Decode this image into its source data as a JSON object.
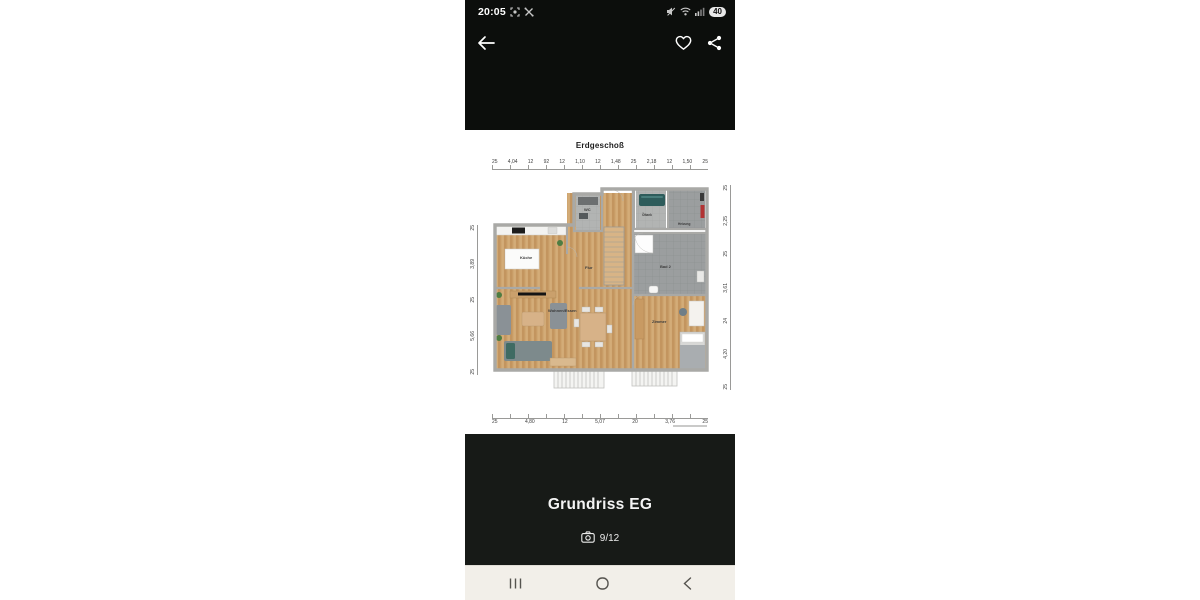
{
  "status_bar": {
    "time": "20:05",
    "left_icons": [
      "screen-record-icon",
      "crossed-tools-icon"
    ],
    "right_icons": [
      "sound-muted-icon",
      "wifi-icon",
      "signal-bars-icon"
    ],
    "battery_percent": "40"
  },
  "app_bar": {
    "icons": [
      "back-arrow-icon",
      "heart-icon",
      "share-icon"
    ]
  },
  "plan": {
    "title": "Erdgeschoß",
    "rooms": {
      "kueche": "Küche",
      "flur": "Flur",
      "wc": "WC",
      "oeltank": "Öltank",
      "heizung": "Heizung",
      "bad2": "Bad 2",
      "zimmer": "Zimmer",
      "wohnen_essen": "Wohnen/Essen"
    },
    "dimensions": {
      "top": [
        "25",
        "4,04",
        "12",
        "92",
        "12",
        "1,10",
        "12",
        "1,48",
        "25",
        "2,18",
        "12",
        "1,50",
        "25"
      ],
      "bottom": [
        "25",
        "4,80",
        "12",
        "5,07",
        "20",
        "3,76",
        "25"
      ],
      "left": [
        "25",
        "3,89",
        "25",
        "5,66",
        "25"
      ],
      "right": [
        "25",
        "2,25",
        "25",
        "3,61",
        "24",
        "4,20",
        "25"
      ]
    }
  },
  "caption": {
    "title": "Grundriss EG",
    "camera_icon": "camera-icon",
    "counter": "9/12"
  },
  "nav_bar": {
    "icons": [
      "recent-apps-icon",
      "home-icon",
      "back-icon"
    ]
  },
  "colors": {
    "header_bg": "#0c0e0c",
    "caption_bg": "#171a17",
    "nav_bg": "#f2efe9",
    "wood_floor": "#cfa671",
    "wood_floor_dark": "#c3955f",
    "tile_gray": "#9b9e9f",
    "tank_teal": "#2e5c5b"
  }
}
